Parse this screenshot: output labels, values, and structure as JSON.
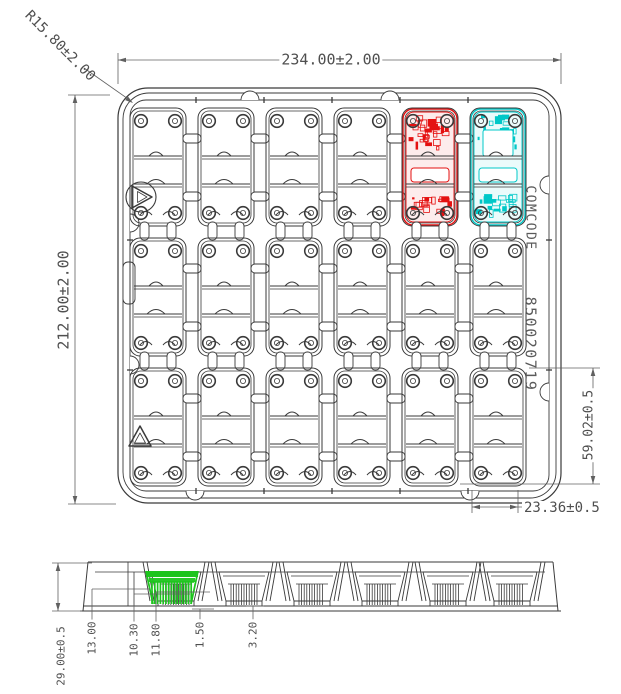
{
  "top_view": {
    "dim_width": "234.00±2.00",
    "dim_height": "212.00±2.00",
    "dim_corner_radius": "R15.80±2.00",
    "dim_pocket_height": "59.02±0.5",
    "dim_pocket_width": "23.36±0.5",
    "marking_code": "COMCODE",
    "marking_number": "850020719",
    "grid": {
      "rows": 3,
      "cols": 6
    },
    "highlights": [
      {
        "name": "pcb-red",
        "row": 0,
        "col": 4,
        "color": "#e41111"
      },
      {
        "name": "pcb-cyan",
        "row": 0,
        "col": 5,
        "color": "#00c8c8"
      }
    ]
  },
  "side_view": {
    "dim_labels": [
      "29.00±0.5",
      "13.00",
      "10.30",
      "11.80",
      "1.50",
      "3.20"
    ],
    "highlight": {
      "name": "pocket-green",
      "color": "#1dc41d"
    }
  },
  "colors": {
    "line": "#3a3a3a",
    "dim_line": "#606060",
    "text": "#4f4f4f"
  }
}
